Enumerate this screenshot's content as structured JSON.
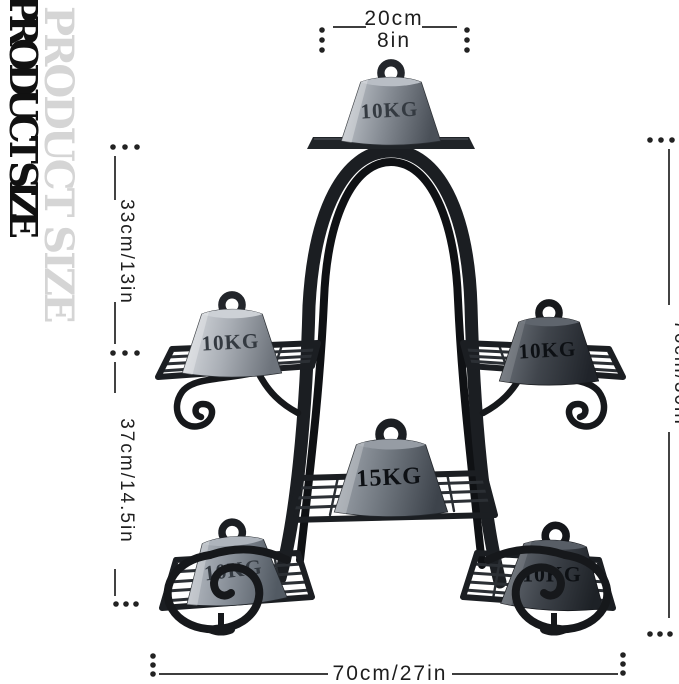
{
  "title": "PRODUCT SIZE",
  "dimensions": {
    "top_width_cm": "20cm",
    "top_width_in": "8in",
    "upper_height": "33cm/13in",
    "lower_height": "37cm/14.5in",
    "total_height": "76cm/30in",
    "total_width": "70cm/27in"
  },
  "weights": {
    "top": "10KG",
    "mid_left": "10KG",
    "mid_right": "10KG",
    "center": "15KG",
    "bottom_left": "10KG",
    "bottom_right": "10KG"
  },
  "colors": {
    "background": "#ffffff",
    "frame": "#1b1e22",
    "dimension_lines": "#222222",
    "title_text": "#111111",
    "title_shadow": "#d5d5d5",
    "weight_light": "#a9aeb5",
    "weight_dark": "#3e434a"
  }
}
